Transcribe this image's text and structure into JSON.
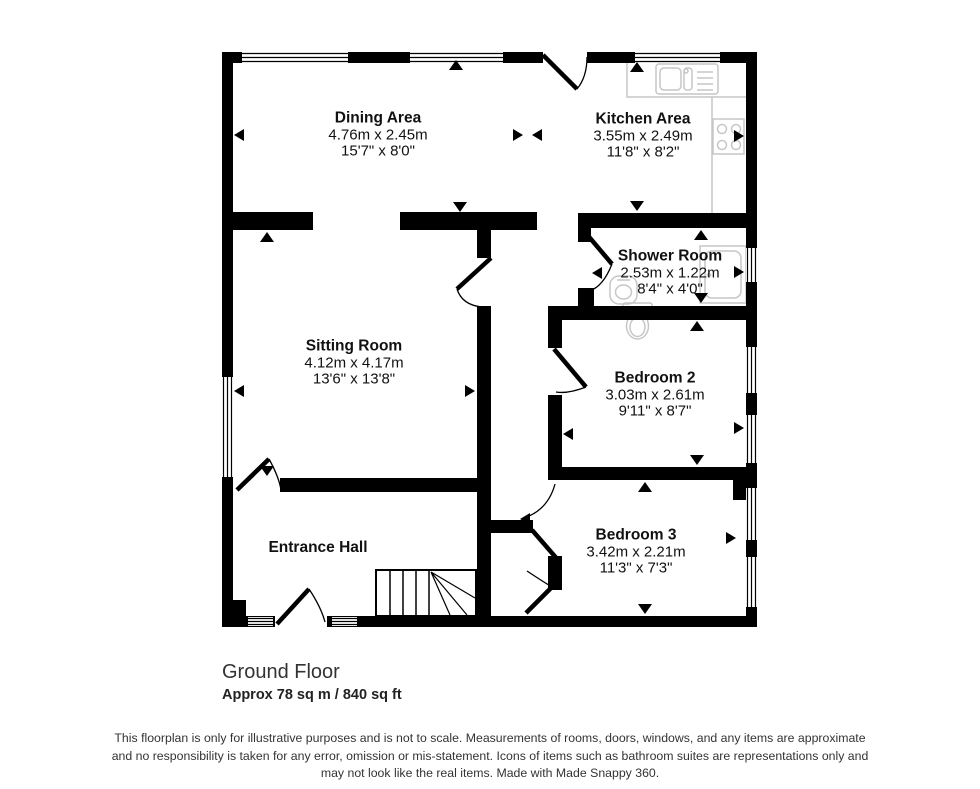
{
  "rooms": {
    "dining": {
      "name": "Dining Area",
      "metric": "4.76m x 2.45m",
      "imperial": "15'7\" x 8'0\""
    },
    "kitchen": {
      "name": "Kitchen Area",
      "metric": "3.55m x 2.49m",
      "imperial": "11'8\" x 8'2\""
    },
    "shower": {
      "name": "Shower Room",
      "metric": "2.53m x 1.22m",
      "imperial": "8'4\" x 4'0\""
    },
    "sitting": {
      "name": "Sitting Room",
      "metric": "4.12m x 4.17m",
      "imperial": "13'6\" x 13'8\""
    },
    "bedroom2": {
      "name": "Bedroom 2",
      "metric": "3.03m x 2.61m",
      "imperial": "9'11\" x 8'7\""
    },
    "bedroom3": {
      "name": "Bedroom 3",
      "metric": "3.42m x 2.21m",
      "imperial": "11'3\" x 7'3\""
    },
    "hall": {
      "name": "Entrance Hall"
    }
  },
  "floor": {
    "title": "Ground Floor",
    "area": "Approx 78 sq m / 840 sq ft"
  },
  "disclaimer": {
    "line1": "This floorplan is only for illustrative purposes and is not to scale. Measurements of rooms, doors, windows, and any items are approximate",
    "line2": "and no responsibility is taken for any error, omission or mis-statement. Icons of items such as bathroom suites are representations only and",
    "line3": "may not look like the real items. Made with Made Snappy 360."
  },
  "colors": {
    "wall": "#000000",
    "fixture": "#c6c6c6",
    "text": "#111111"
  }
}
